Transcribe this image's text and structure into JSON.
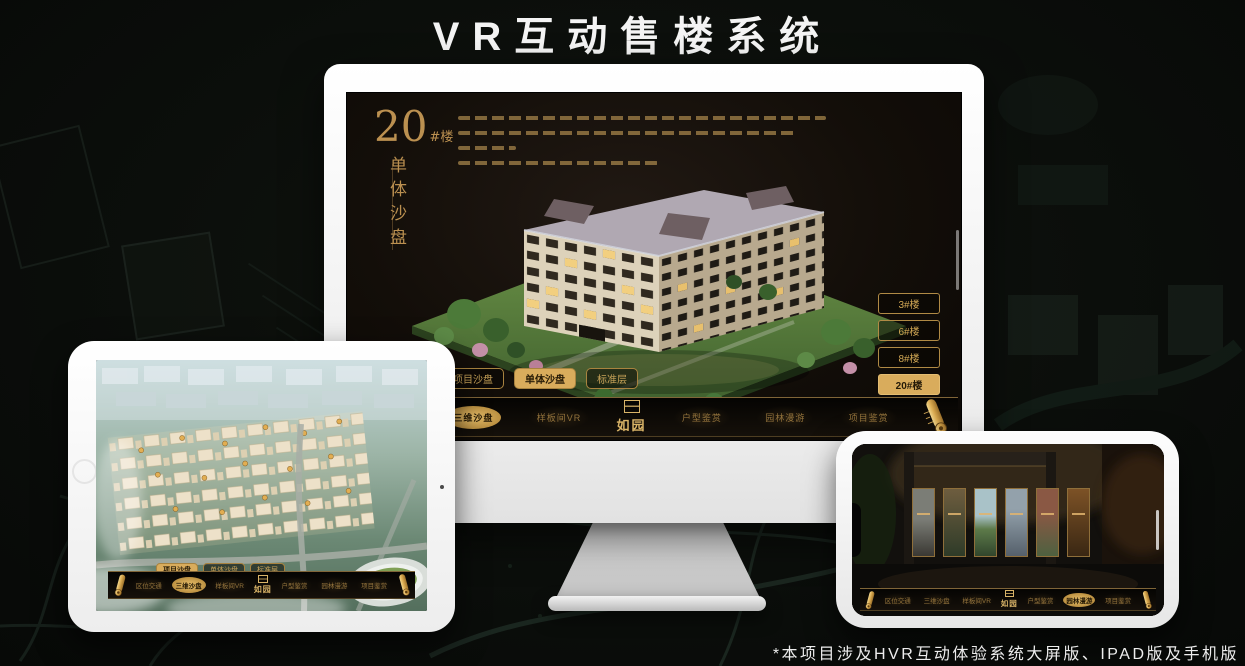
{
  "page": {
    "title": "VR互动售楼系统",
    "footnote": "*本项目涉及HVR互动体验系统大屏版、IPAD版及手机版"
  },
  "colors": {
    "gold": "#c9a55a",
    "gold_fill": "#d9ac5c",
    "gold_deep": "#8a6326",
    "screen_bg": "#15100b",
    "selected_text": "#241a08"
  },
  "monitor_app": {
    "unit_panel": {
      "number": "20",
      "suffix": "#楼",
      "subtitle": "单体沙盘"
    },
    "building_buttons": [
      {
        "label": "3#楼",
        "selected": false
      },
      {
        "label": "6#楼",
        "selected": false
      },
      {
        "label": "8#楼",
        "selected": false
      },
      {
        "label": "20#楼",
        "selected": true
      }
    ],
    "view_tabs": [
      {
        "label": "项目沙盘",
        "selected": false
      },
      {
        "label": "单体沙盘",
        "selected": true
      },
      {
        "label": "标准层",
        "selected": false
      }
    ],
    "nav": {
      "logo": "如园",
      "items": [
        {
          "label": "区位交通",
          "selected": false
        },
        {
          "label": "三维沙盘",
          "selected": true
        },
        {
          "label": "样板间VR",
          "selected": false
        },
        {
          "label": "户型鉴赏",
          "selected": false
        },
        {
          "label": "园林漫游",
          "selected": false
        },
        {
          "label": "项目鉴赏",
          "selected": false
        }
      ]
    }
  },
  "tablet_app": {
    "view_tabs": [
      {
        "label": "项目沙盘",
        "selected": true
      },
      {
        "label": "单体沙盘",
        "selected": false
      },
      {
        "label": "标准层",
        "selected": false
      }
    ],
    "nav": {
      "logo": "如园",
      "items": [
        {
          "label": "区位交通",
          "selected": false
        },
        {
          "label": "三维沙盘",
          "selected": true
        },
        {
          "label": "样板间VR",
          "selected": false
        },
        {
          "label": "户型鉴赏",
          "selected": false
        },
        {
          "label": "园林漫游",
          "selected": false
        },
        {
          "label": "项目鉴赏",
          "selected": false
        }
      ]
    }
  },
  "phone_app": {
    "nav": {
      "logo": "如园",
      "items": [
        {
          "label": "区位交通",
          "selected": false
        },
        {
          "label": "三维沙盘",
          "selected": false
        },
        {
          "label": "样板间VR",
          "selected": false
        },
        {
          "label": "户型鉴赏",
          "selected": false
        },
        {
          "label": "园林漫游",
          "selected": true
        },
        {
          "label": "项目鉴赏",
          "selected": false
        }
      ]
    }
  }
}
